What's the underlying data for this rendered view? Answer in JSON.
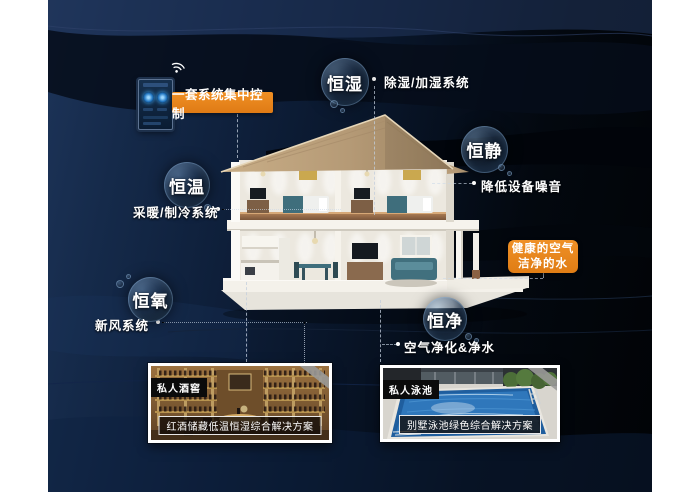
{
  "poster": {
    "accent_color": "#e8831d",
    "control": {
      "label": "一套系统集中控制"
    },
    "bubbles": {
      "humidity": {
        "label": "恒湿",
        "note": "除湿/加湿系统"
      },
      "quiet": {
        "label": "恒静",
        "note": "降低设备噪音"
      },
      "temperature": {
        "label": "恒温",
        "note": "采暖/制冷系统"
      },
      "oxygen": {
        "label": "恒氧",
        "note": "新风系统"
      },
      "purity": {
        "label": "恒净",
        "note": "空气净化&净水"
      }
    },
    "highlight": {
      "line1": "健康的空气",
      "line2": "洁净的水"
    },
    "photos": {
      "wine": {
        "tag": "私人酒窖",
        "caption": "红酒储藏低温恒湿综合解决方案"
      },
      "pool": {
        "tag": "私人泳池",
        "caption": "别墅泳池绿色综合解决方案"
      }
    }
  }
}
